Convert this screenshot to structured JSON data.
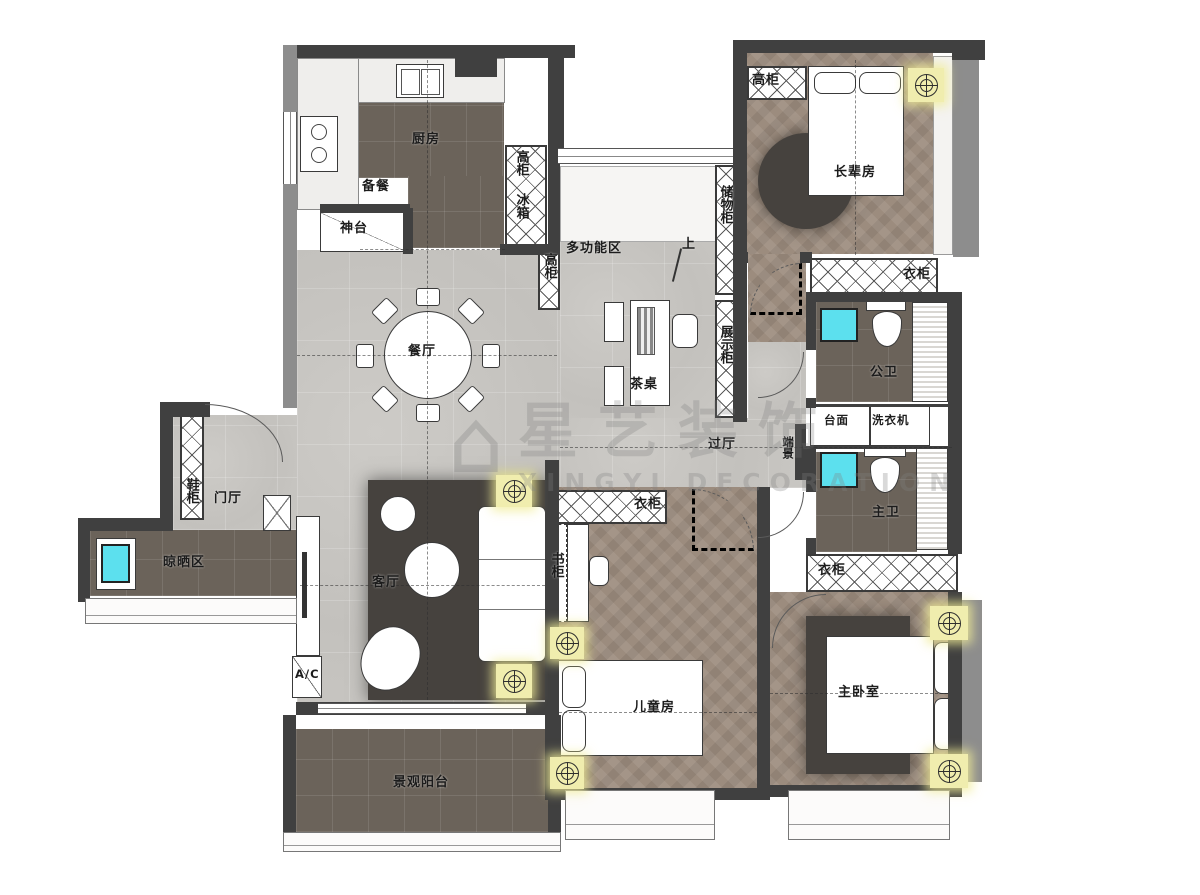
{
  "watermark": {
    "cn": "星艺装饰",
    "en": "XINGYI DECORATION"
  },
  "labels": {
    "kitchen": "厨房",
    "tall_cabinet": "高柜",
    "prep": "备餐",
    "fridge": "冰箱",
    "altar": "神台",
    "multi_function": "多功能区",
    "storage_cabinet": "储物柜",
    "up": "上",
    "elder_room": "长辈房",
    "wardrobe": "衣柜",
    "public_bath": "公卫",
    "counter": "台面",
    "washing_machine": "洗衣机",
    "end_view": "端景",
    "master_bath": "主卫",
    "dining": "餐厅",
    "tea_table": "茶桌",
    "display_cabinet": "展示柜",
    "hallway": "过厅",
    "shoe_cabinet": "鞋柜",
    "foyer": "门厅",
    "drying_area": "晾晒区",
    "living": "客厅",
    "bookcase": "书柜",
    "children_room": "儿童房",
    "master_bedroom": "主卧室",
    "ac": "A/C",
    "balcony": "景观阳台"
  },
  "colors": {
    "wall_dark": "#404040",
    "wall_light": "#8d8d8d",
    "floor_tile": "#c7c5c1",
    "floor_wood": "#9c8c7e",
    "floor_dark": "#6b635a",
    "rug": "#46423e",
    "accent_cyan": "#5ce0ee",
    "accent_yellow": "#f0edae"
  }
}
